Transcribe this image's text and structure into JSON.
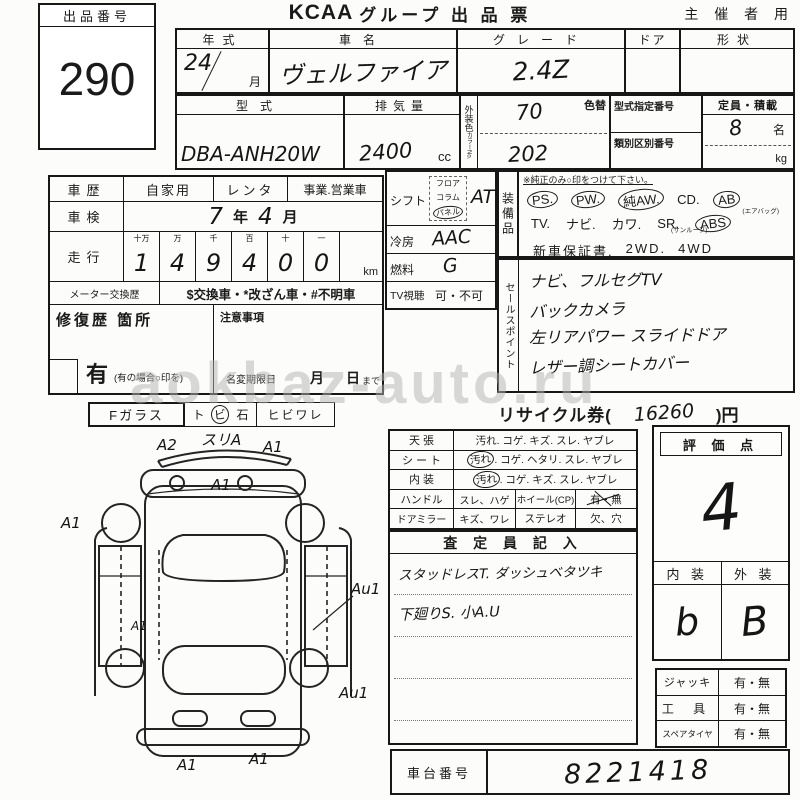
{
  "watermark": "aokbaz-auto.ru",
  "header": {
    "auction_no_label": "出品番号",
    "auction_no": "290",
    "logo": "KCAA",
    "title": "グループ 出 品 票",
    "corner": "主 催 者 用"
  },
  "t1": {
    "h_year": "年式",
    "h_name": "車名",
    "h_grade": "グレード",
    "h_door": "ドア",
    "h_shape": "形状",
    "year": "24",
    "year_month": "月",
    "name": "ヴェルファイア",
    "grade": "2.4Z"
  },
  "t2": {
    "h_model": "型式",
    "model": "DBA-ANH20W",
    "h_disp": "排気量",
    "disp": "2400",
    "disp_unit": "cc",
    "color_strip": "外装色",
    "color_no": "カラーNo.",
    "h_color_change": "色替",
    "color_top": "70",
    "color_bottom": "202",
    "h_type_no": "型式指定番号",
    "h_class_no": "類別区別番号",
    "h_capacity": "定員・積載",
    "capacity": "8",
    "capacity_unit": "名",
    "weight_unit": "kg"
  },
  "hist": {
    "h_shareki": "車歴",
    "opt1": "自家用",
    "opt2": "レンタ",
    "opt3": "事業.営業車",
    "h_shaken": "車検",
    "shaken_y": "7",
    "shaken_y_unit": "年",
    "shaken_m": "4",
    "shaken_m_unit": "月",
    "h_soukou": "走行",
    "digit_headers": [
      "十万",
      "万",
      "千",
      "百",
      "十",
      "一"
    ],
    "digits": [
      "1",
      "4",
      "9",
      "4",
      "0",
      "0"
    ],
    "km_unit": "km",
    "h_meter": "メーター交換歴",
    "meter_text": "$交換車・*改ざん車・#不明車",
    "h_repair": "修復歴 箇所",
    "repair_yes": "有",
    "repair_note": "(有の場合○印を)",
    "h_note": "注意事項",
    "name_change": "名変期限日",
    "month": "月",
    "day": "日",
    "day_suffix": "まで"
  },
  "drive": {
    "h_shift": "シフト",
    "shift_opt1": "フロア",
    "shift_opt2": "コラム",
    "shift_opt3": "パネル",
    "shift_value": "AT",
    "h_ac": "冷房",
    "ac_value": "AAC",
    "h_fuel": "燃料",
    "fuel_value": "G",
    "h_tv": "TV視聴",
    "tv_value": "可・不可"
  },
  "equip": {
    "strip": "装備品",
    "note": "※純正のみ○印をつけて下さい。",
    "ps": "PS.",
    "pw": "PW.",
    "aw": "純AW.",
    "cd": "CD.",
    "ab": "AB",
    "tv": "TV.",
    "navi": "ナビ.",
    "kawa": "カワ.",
    "sr": "SR.",
    "sr_note": "(サンルーフ)",
    "ab_note": "(エアバッグ)",
    "abs": "ABS",
    "warranty": "新車保証書.",
    "wd2": "2WD.",
    "wd4": "4WD"
  },
  "sales": {
    "strip": "セールスポイント",
    "lines": [
      "ナビ、フルセグTV",
      "バックカメラ",
      "左リアパワー スライドドア",
      "レザー調シートカバー"
    ]
  },
  "recycle": {
    "label": "リサイクル券(",
    "value": "16260",
    "suffix": ")円"
  },
  "fglass": {
    "label": "Fガラス",
    "c1": "ト",
    "c2": "ビ",
    "c3": "石",
    "c4": "ヒビワレ"
  },
  "cond": {
    "r1_label": "天 張",
    "r1_text": "汚れ. コゲ. キズ. スレ. ヤブレ",
    "r2_label": "シ ー ト",
    "r2_pre": "汚れ",
    "r2_text": ". コゲ. ヘタリ. スレ. ヤブレ",
    "r3_label": "内 装",
    "r3_pre": "汚れ",
    "r3_text": ". コゲ. キズ. スレ. ヤブレ",
    "r4_label": "ハンドル",
    "r4_c1": "スレ、ハゲ",
    "r4_c2": "ホイール(CP)",
    "r4_c3": "有・無",
    "r5_label": "ドアミラー",
    "r5_c1": "キズ、ワレ",
    "r5_c2": "ステレオ",
    "r5_c3": "欠、穴"
  },
  "assessor": {
    "title": "査 定 員 記 入",
    "line1": "スタッドレスT. ダッシュベタツキ",
    "line2": "下廻りS. 小A.U"
  },
  "score": {
    "title": "評 価 点",
    "value": "4",
    "h_interior": "内 装",
    "h_exterior": "外 装",
    "interior": "b",
    "exterior": "B"
  },
  "acc": {
    "r1_label": "ジャッキ",
    "r1_value": "有・無",
    "r2_label": "工 具",
    "r2_value": "有・無",
    "r3_label": "スペアタイヤ",
    "r3_value": "有・無"
  },
  "chassis": {
    "label": "車台番号",
    "value": "8221418"
  },
  "diagram": {
    "a1": "A2",
    "a2": "スリA",
    "a3": "A1",
    "a4": "A1",
    "a5": "A1",
    "a6": "A1",
    "a7": "Au1",
    "a8": "Au1",
    "a9": "A1",
    "a10": "A1"
  }
}
